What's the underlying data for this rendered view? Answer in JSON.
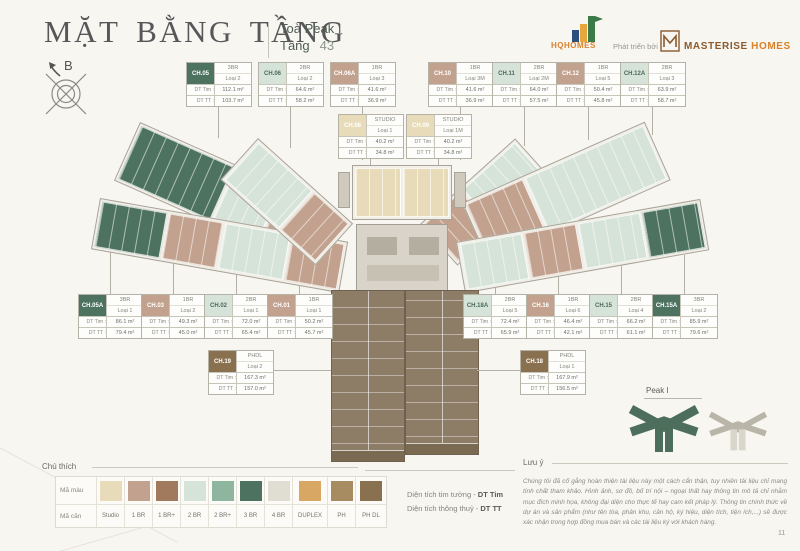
{
  "header": {
    "title": "MẶT BẰNG TẦNG",
    "tower": "Toà Peak I",
    "floor_label": "Tầng",
    "floor_value": "43"
  },
  "branding": {
    "hqhomes": "HQHOMES",
    "developed_by": "Phát triển bởi",
    "masterise_1": "MASTERISE",
    "masterise_2": "HOMES"
  },
  "compass": {
    "north": "B"
  },
  "card_labels": {
    "tim": "DT Tim :",
    "tt": "DT TT :"
  },
  "units": [
    {
      "code": "CH.05",
      "type": "3BR",
      "variant": "Loại 2",
      "tim": "112.1 m²",
      "tt": "103.7 m²",
      "color": "#4d7260",
      "text_color": "#ffffff"
    },
    {
      "code": "CH.06",
      "type": "2BR",
      "variant": "Loại 2",
      "tim": "64.6 m²",
      "tt": "58.2 m²",
      "color": "#d6e3d8",
      "text_color": "#4a6a58"
    },
    {
      "code": "CH.06A",
      "type": "1BR",
      "variant": "Loại 3",
      "tim": "41.6 m²",
      "tt": "36.9 m²",
      "color": "#c2a28e",
      "text_color": "#ffffff"
    },
    {
      "code": "CH.10",
      "type": "1BR",
      "variant": "Loại 3M",
      "tim": "41.6 m²",
      "tt": "36.9 m²",
      "color": "#c2a28e",
      "text_color": "#ffffff"
    },
    {
      "code": "CH.11",
      "type": "2BR",
      "variant": "Loại 2M",
      "tim": "64.0 m²",
      "tt": "57.5 m²",
      "color": "#d6e3d8",
      "text_color": "#4a6a58"
    },
    {
      "code": "CH.12",
      "type": "1BR",
      "variant": "Loại 5",
      "tim": "50.4 m²",
      "tt": "45.8 m²",
      "color": "#c2a28e",
      "text_color": "#ffffff"
    },
    {
      "code": "CH.12A",
      "type": "2BR",
      "variant": "Loại 3",
      "tim": "63.9 m²",
      "tt": "58.7 m²",
      "color": "#d6e3d8",
      "text_color": "#4a6a58"
    },
    {
      "code": "CH.08",
      "type": "STUDIO",
      "variant": "Loại 1",
      "tim": "40.2 m²",
      "tt": "34.8 m²",
      "color": "#e8dbb9",
      "text_color": "#ffffff"
    },
    {
      "code": "CH.09",
      "type": "STUDIO",
      "variant": "Loại 1M",
      "tim": "40.2 m²",
      "tt": "34.8 m²",
      "color": "#e8dbb9",
      "text_color": "#ffffff"
    },
    {
      "code": "CH.05A",
      "type": "3BR",
      "variant": "Loại 1",
      "tim": "86.1 m²",
      "tt": "79.4 m²",
      "color": "#4d7260",
      "text_color": "#ffffff"
    },
    {
      "code": "CH.03",
      "type": "1BR",
      "variant": "Loại 2",
      "tim": "49.3 m²",
      "tt": "45.0 m²",
      "color": "#c2a28e",
      "text_color": "#ffffff"
    },
    {
      "code": "CH.02",
      "type": "2BR",
      "variant": "Loại 1",
      "tim": "72.0 m²",
      "tt": "65.4 m²",
      "color": "#d6e3d8",
      "text_color": "#4a6a58"
    },
    {
      "code": "CH.01",
      "type": "1BR",
      "variant": "Loại 1",
      "tim": "50.2 m²",
      "tt": "45.7 m²",
      "color": "#c2a28e",
      "text_color": "#ffffff"
    },
    {
      "code": "CH.18A",
      "type": "2BR",
      "variant": "Loại 5",
      "tim": "72.4 m²",
      "tt": "65.9 m²",
      "color": "#d6e3d8",
      "text_color": "#4a6a58"
    },
    {
      "code": "CH.16",
      "type": "1BR",
      "variant": "Loại 6",
      "tim": "46.4 m²",
      "tt": "42.1 m²",
      "color": "#c2a28e",
      "text_color": "#ffffff"
    },
    {
      "code": "CH.15",
      "type": "2BR",
      "variant": "Loại 4",
      "tim": "66.2 m²",
      "tt": "61.1 m²",
      "color": "#d6e3d8",
      "text_color": "#4a6a58"
    },
    {
      "code": "CH.15A",
      "type": "3BR",
      "variant": "Loại 2",
      "tim": "85.9 m²",
      "tt": "79.6 m²",
      "color": "#4d7260",
      "text_color": "#ffffff"
    },
    {
      "code": "CH.19",
      "type": "PHDL",
      "variant": "Loại 2",
      "tim": "167.3 m²",
      "tt": "157.0 m²",
      "color": "#89704f",
      "text_color": "#ffffff"
    },
    {
      "code": "CH.18",
      "type": "PHDL",
      "variant": "Loại 1",
      "tim": "167.9 m²",
      "tt": "156.5 m²",
      "color": "#89704f",
      "text_color": "#ffffff"
    }
  ],
  "legend": {
    "title": "Chú thích",
    "color_row": "Mã màu",
    "unit_row": "Mã căn",
    "types": [
      {
        "label": "Studio",
        "color": "#e8dbb9"
      },
      {
        "label": "1 BR",
        "color": "#c2a28e"
      },
      {
        "label": "1 BR+",
        "color": "#a1795d"
      },
      {
        "label": "2 BR",
        "color": "#d6e3d8"
      },
      {
        "label": "2 BR+",
        "color": "#8eb69e"
      },
      {
        "label": "3 BR",
        "color": "#4d7260"
      },
      {
        "label": "4 BR",
        "color": "#e0ddd2"
      },
      {
        "label": "DUPLEX",
        "color": "#d8a763"
      },
      {
        "label": "PH",
        "color": "#a78c61"
      },
      {
        "label": "PH DL",
        "color": "#89704f"
      }
    ]
  },
  "area_key": {
    "tim_text": "Diện tích tim tường - ",
    "tim_bold": "DT Tim",
    "tt_text": "Diện tích thông thuỷ - ",
    "tt_bold": "DT TT"
  },
  "note": {
    "title": "Lưu ý",
    "body": "Chúng tôi đã cố gắng hoàn thiện tài liệu này một cách cẩn thận, tuy nhiên tài liệu chỉ mang tính chất tham khảo. Hình ảnh, sơ đồ, bố trí nội – ngoại thất hay thông tin mô tả chỉ nhằm mục đích minh họa, không đại diện cho thực tế hay cam kết pháp lý. Thông tin chính thức về dự án và sản phẩm (như tên tòa, phân khu, căn hộ, ký hiệu, diện tích, tiện ích,...) sẽ được xác nhận trong hợp đồng mua bán và các tài liệu ký với khách hàng."
  },
  "key_map": {
    "label": "Peak I"
  },
  "page_number": "11",
  "colors": {
    "studio": "#e8dbb9",
    "br1": "#c2a28e",
    "br1p": "#a1795d",
    "br2": "#d6e3d8",
    "br2p": "#8eb69e",
    "br3": "#4d7260",
    "br4": "#e0ddd2",
    "duplex": "#d8a763",
    "ph": "#a78c61",
    "phdl": "#89704f"
  }
}
